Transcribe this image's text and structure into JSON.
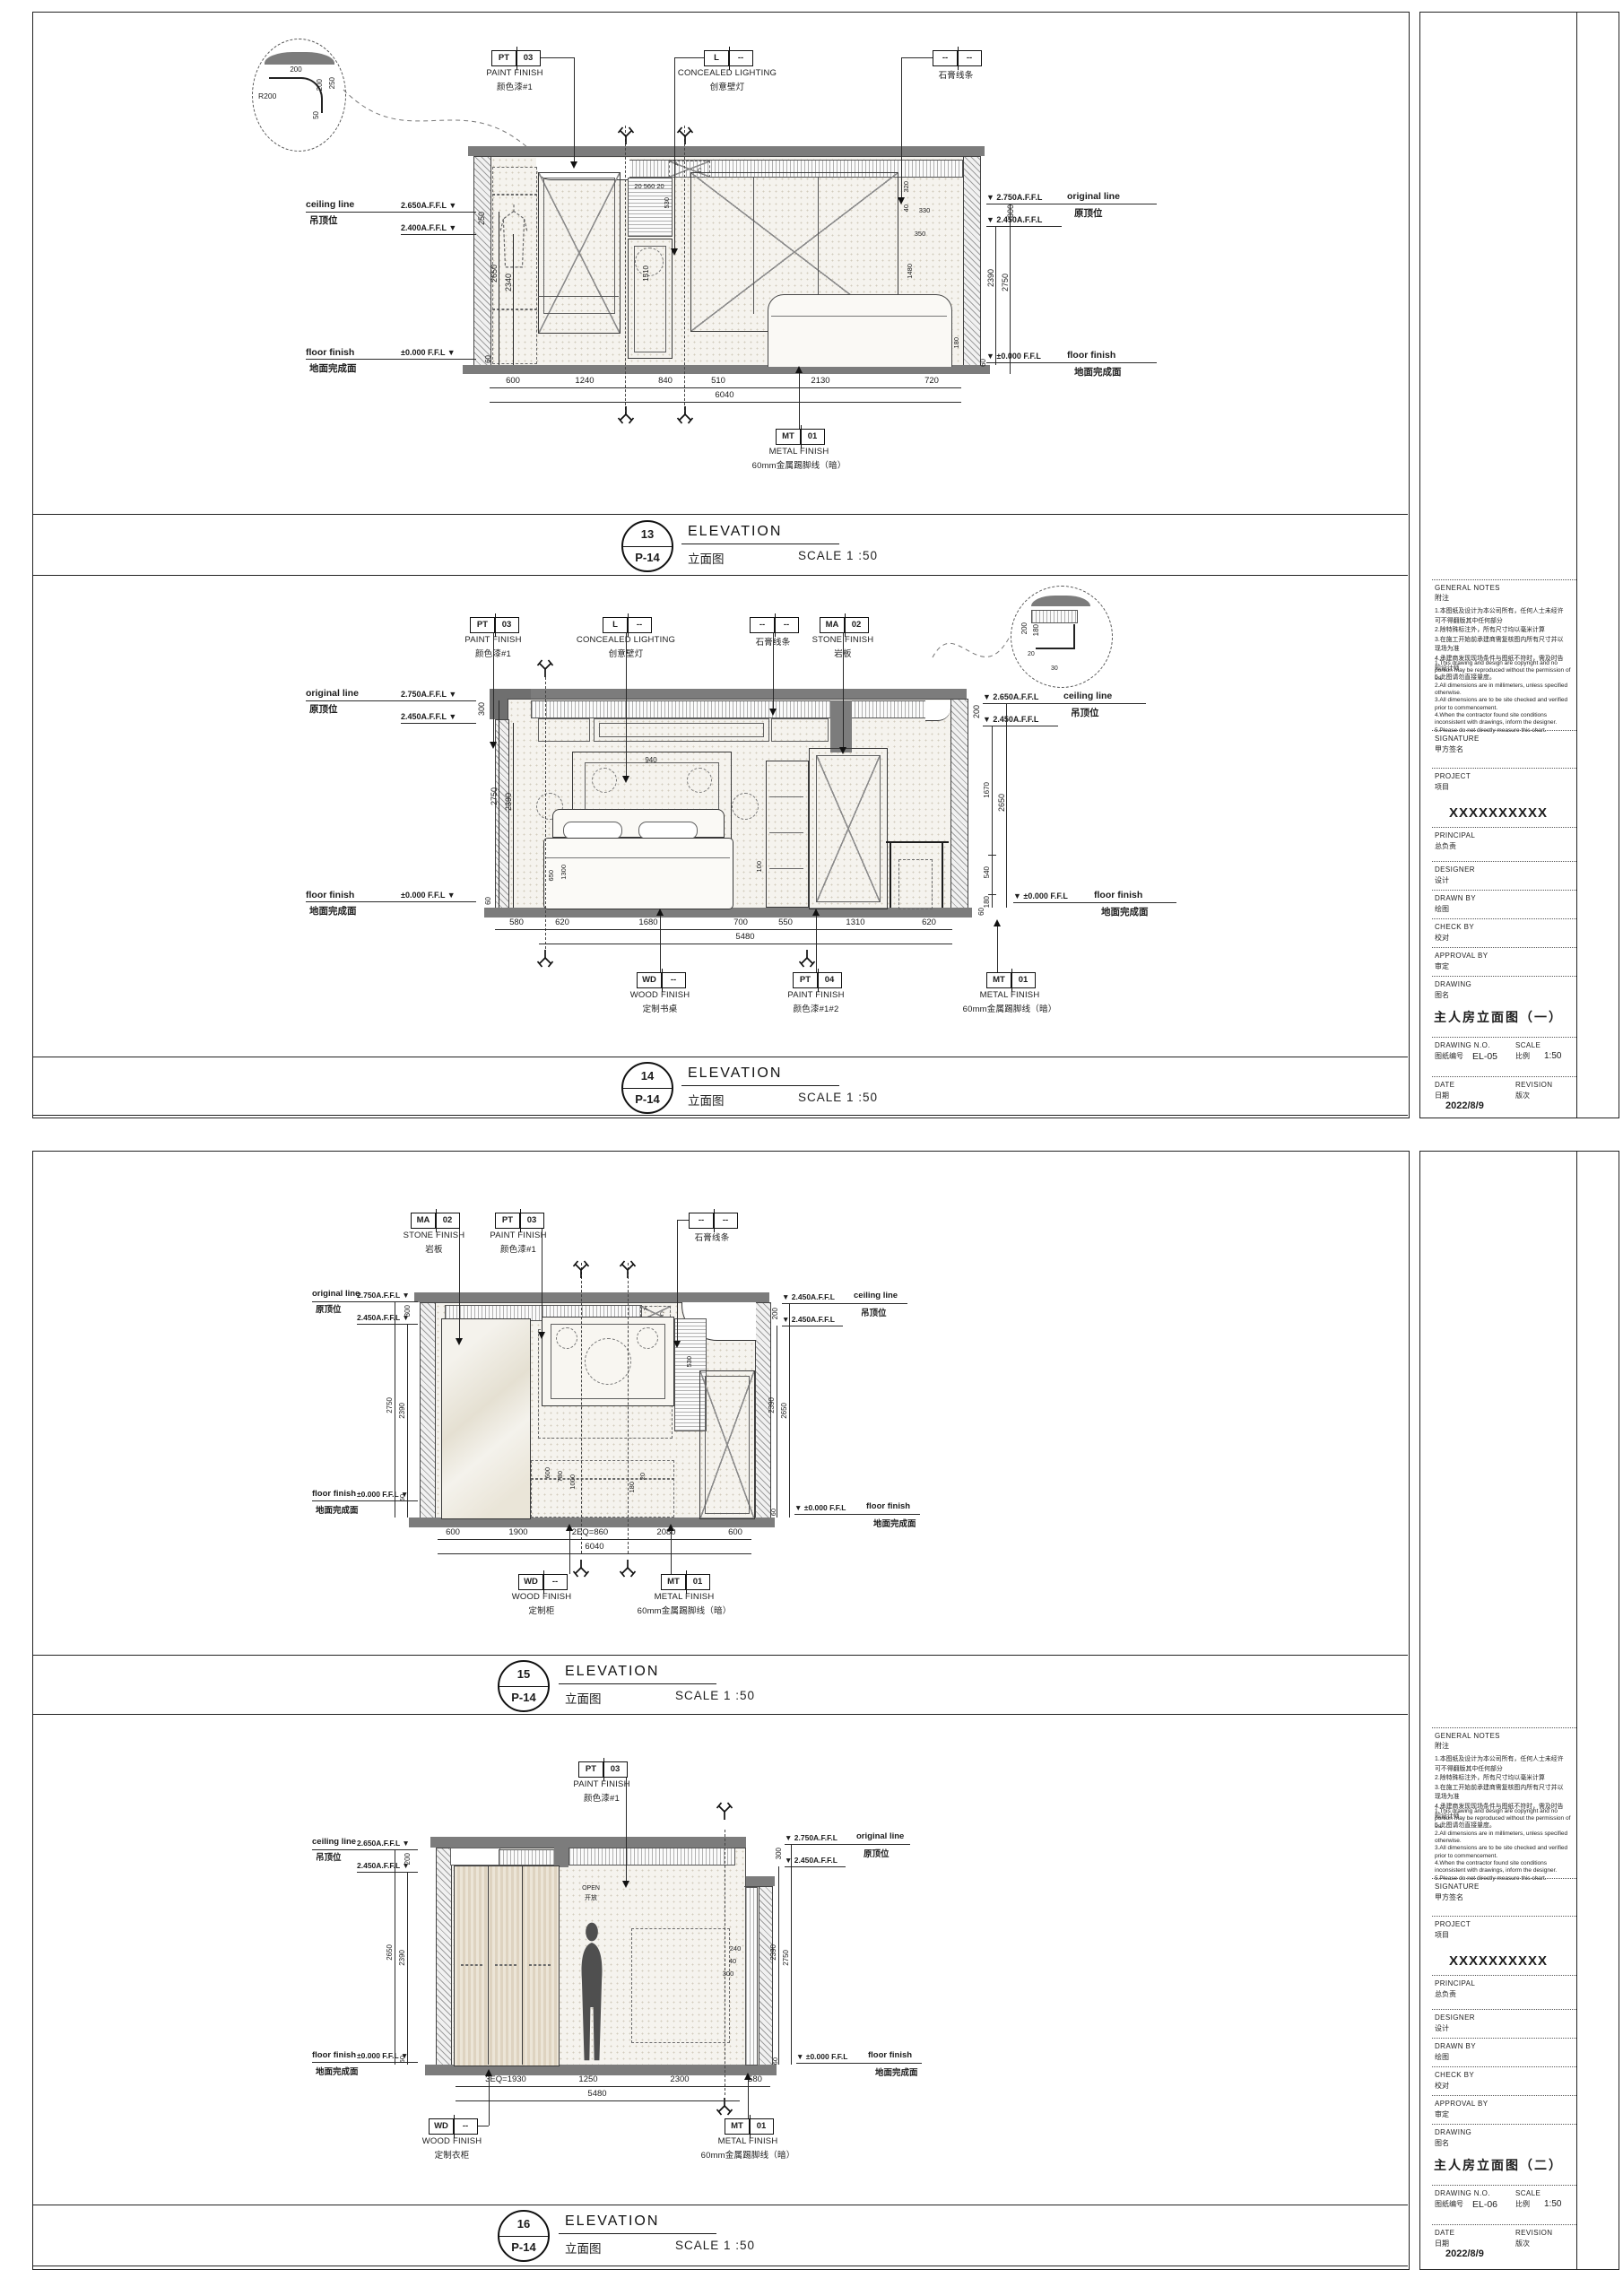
{
  "shared": {
    "elevation_en": "ELEVATION",
    "elevation_zh": "立面图",
    "scale_label": "SCALE 1 :50",
    "ref": "P-14",
    "ceiling_en": "ceiling line",
    "ceiling_zh": "吊顶位",
    "original_en": "original line",
    "original_zh": "原顶位",
    "floor_en": "floor finish",
    "floor_zh": "地面完成面",
    "floor_lv_left": "±0.000 F.F.L ▼",
    "floor_lv_right": "▼ ±0.000 F.F.L",
    "open_en": "OPEN",
    "open_zh": "开放",
    "ac_a": "A",
    "ac_c": "C"
  },
  "callouts": {
    "pt03": {
      "a": "PT",
      "b": "03",
      "en": "PAINT FINISH",
      "zh": "颜色漆#1"
    },
    "light": {
      "a": "L",
      "b": "--",
      "en": "CONCEALED LIGHTING",
      "zh": "创意壁灯"
    },
    "gypsum": {
      "a": "--",
      "b": "--",
      "en": "石膏线条"
    },
    "ma02": {
      "a": "MA",
      "b": "02",
      "en": "STONE FINISH",
      "zh": "岩板"
    },
    "mt01": {
      "a": "MT",
      "b": "01",
      "en": "METAL FINISH",
      "zh": "60mm金属踢脚线（暗）"
    },
    "pt04": {
      "a": "PT",
      "b": "04",
      "en": "PAINT FINISH",
      "zh": "颜色漆#1#2"
    },
    "wd_desk": {
      "a": "WD",
      "b": "--",
      "en": "WOOD FINISH",
      "zh": "定制书桌"
    },
    "wd_cab": {
      "a": "WD",
      "b": "--",
      "en": "WOOD FINISH",
      "zh": "定制柜"
    },
    "wd_ward": {
      "a": "WD",
      "b": "--",
      "en": "WOOD FINISH",
      "zh": "定制衣柜"
    }
  },
  "e13": {
    "no": "13",
    "left_lv1": "2.650A.F.F.L ▼",
    "left_lv2": "2.400A.F.F.L ▼",
    "left_gap": "250",
    "left_d1": "2650",
    "left_d2": "2340",
    "right_lv1": "▼ 2.750A.F.F.L",
    "right_lv2": "▼ 2.450A.F.F.L",
    "right_gap": "300",
    "right_d1": "2390",
    "right_d2": "2750",
    "floor_gap": "60",
    "dims": [
      "600",
      "1240",
      "840",
      "510",
      "2130",
      "720"
    ],
    "total": "6040",
    "inner": [
      "20 560 20",
      "530",
      "1510",
      "320",
      "40",
      "350",
      "330",
      "1480",
      "180"
    ],
    "detail": {
      "r": "R200",
      "a": "200",
      "b": "200",
      "c": "250",
      "d": "50"
    }
  },
  "e14": {
    "no": "14",
    "left_lv1": "2.750A.F.F.L ▼",
    "left_lv2": "2.450A.F.F.L ▼",
    "left_gap": "300",
    "left_d1": "2750",
    "left_d2": "2390",
    "right_lv1": "▼ 2.650A.F.F.L",
    "right_lv2": "▼ 2.450A.F.F.L",
    "right_gap": "200",
    "right_d1": "2650",
    "right_chain": [
      "1670",
      "540",
      "180"
    ],
    "floor_gap": "60",
    "dims": [
      "580",
      "620",
      "1680",
      "700",
      "550",
      "1310",
      "620"
    ],
    "total": "5480",
    "inner": [
      "940",
      "650",
      "1300",
      "100"
    ],
    "detail": {
      "a": "200",
      "b": "180",
      "c": "20",
      "d": "30"
    }
  },
  "e15": {
    "no": "15",
    "left_lv1": "2.750A.F.F.L ▼",
    "left_lv2": "2.450A.F.F.L ▼",
    "left_gap": "300",
    "left_d1": "2750",
    "left_d2": "2390",
    "right_lv1": "▼ 2.650A.F.F.L",
    "right_lv2": "▼ 2.450A.F.F.L",
    "right_gap": "200",
    "right_d1": "2390",
    "right_d2": "2650",
    "floor_gap": "60",
    "dims": [
      "600",
      "1900",
      "2EQ=860",
      "2080",
      "600"
    ],
    "total": "6040",
    "inner": [
      "530",
      "600",
      "780",
      "1000",
      "180",
      "20"
    ]
  },
  "e16": {
    "no": "16",
    "left_lv1": "2.650A.F.F.L ▼",
    "left_lv2": "2.450A.F.F.L ▼",
    "left_gap": "200",
    "left_d1": "2650",
    "left_d2": "2390",
    "right_lv1": "▼ 2.750A.F.F.L",
    "right_lv2": "▼ 2.450A.F.F.L",
    "right_gap": "300",
    "right_d1": "2390",
    "right_d2": "2750",
    "floor_gap": "60",
    "dims": [
      "3EQ=1930",
      "1250",
      "2300",
      "580"
    ],
    "total": "5480",
    "inner": [
      "240",
      "40",
      "300"
    ]
  },
  "titleblock": {
    "general_en": "GENERAL NOTES",
    "general_zh": "附注",
    "notes_zh": "1.本图纸及设计为本公司所有，任何人士未经许可不得翻版其中任何部分\n2.除特殊标注外，所有尺寸均以毫米计算\n3.在施工开始前承建商需复核图内所有尺寸并以现场为准\n4.承建商发现现场条件与图纸不符时，需及时告知设计师\n5.此图请勿直接量度。",
    "notes_en": "1.This drawing and design are copyright and no portion may be reproduced without the permission of us.\n2.All dimensions are in millimeters, unless specified otherwise.\n3.All dimensions are to be site checked and verified prior to commencement.\n4.When the contractor found site conditions inconsistent with drawings, inform the designer.\n5.Please do not directly measure this chart.",
    "signature_en": "SIGNATURE",
    "signature_zh": "甲方签名",
    "project_en": "PROJECT",
    "project_zh": "项目",
    "project_name": "XXXXXXXXXX",
    "principal_en": "PRINCIPAL",
    "principal_zh": "总负责",
    "designer_en": "DESIGNER",
    "designer_zh": "设计",
    "drawn_en": "DRAWN BY",
    "drawn_zh": "绘图",
    "check_en": "CHECK BY",
    "check_zh": "校对",
    "approval_en": "APPROVAL BY",
    "approval_zh": "审定",
    "drawing_en": "DRAWING",
    "drawing_zh": "图名",
    "no_en": "DRAWING N.O.",
    "no_zh": "图纸编号",
    "scale_en": "SCALE",
    "scale_zh": "比例",
    "scale_val": "1:50",
    "date_en": "DATE",
    "date_zh": "日期",
    "date_val": "2022/8/9",
    "rev_en": "REVISION",
    "rev_zh": "版次"
  },
  "sheet1": {
    "drawing_name": "主人房立面图（一）",
    "drawing_no": "EL-05"
  },
  "sheet2": {
    "drawing_name": "主人房立面图（二）",
    "drawing_no": "EL-06"
  }
}
